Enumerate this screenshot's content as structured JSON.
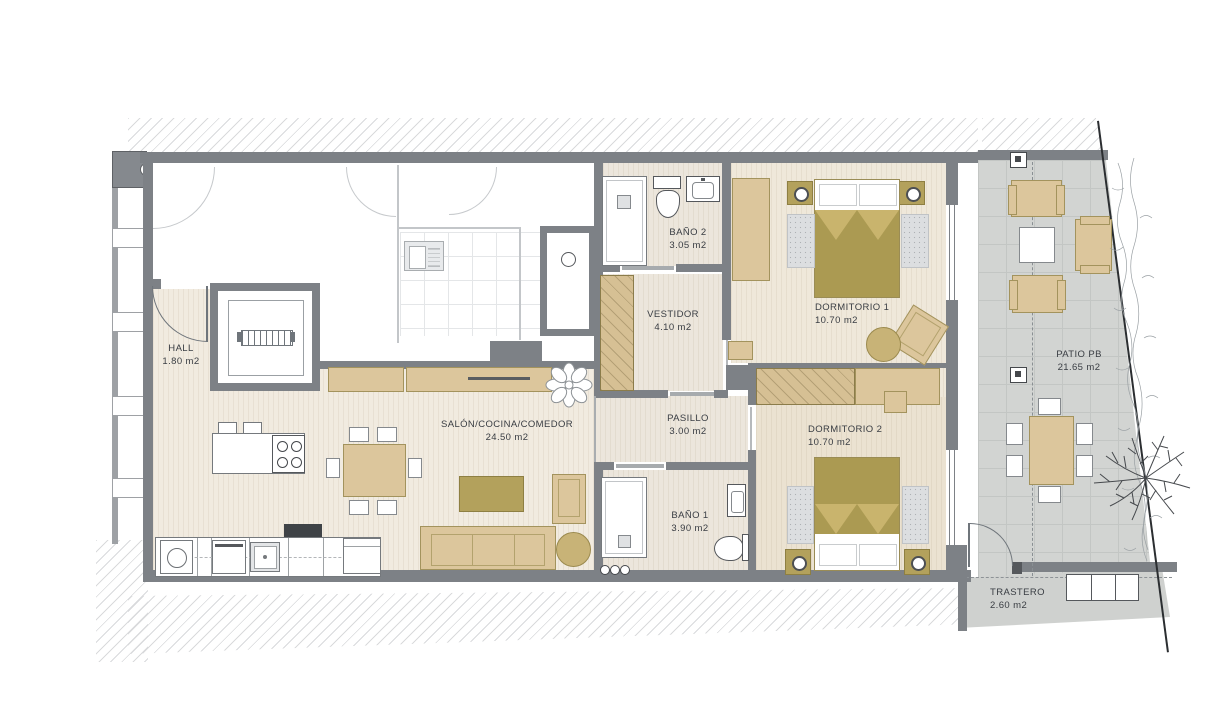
{
  "title": "Apartment floor plan",
  "rooms": [
    {
      "name": "HALL",
      "area": "1.80 m2"
    },
    {
      "name": "SALÓN/COCINA/COMEDOR",
      "area": "24.50 m2"
    },
    {
      "name": "BAÑO 2",
      "area": "3.05 m2"
    },
    {
      "name": "VESTIDOR",
      "area": "4.10 m2"
    },
    {
      "name": "DORMITORIO 1",
      "area": "10.70 m2"
    },
    {
      "name": "PASILLO",
      "area": "3.00 m2"
    },
    {
      "name": "DORMITORIO 2",
      "area": "10.70 m2"
    },
    {
      "name": "BAÑO 1",
      "area": "3.90 m2"
    },
    {
      "name": "PATIO PB",
      "area": "21.65 m2"
    },
    {
      "name": "TRASTERO",
      "area": "2.60 m2"
    }
  ],
  "colors": {
    "wall": "#7d8186",
    "wood_floor": "#f1ebe0",
    "furniture_tan": "#dcc69c",
    "furniture_olive": "#b3a15c",
    "patio_gray": "#d2d4d2",
    "text": "#393d43",
    "boundary_line": "#2b2e31"
  }
}
